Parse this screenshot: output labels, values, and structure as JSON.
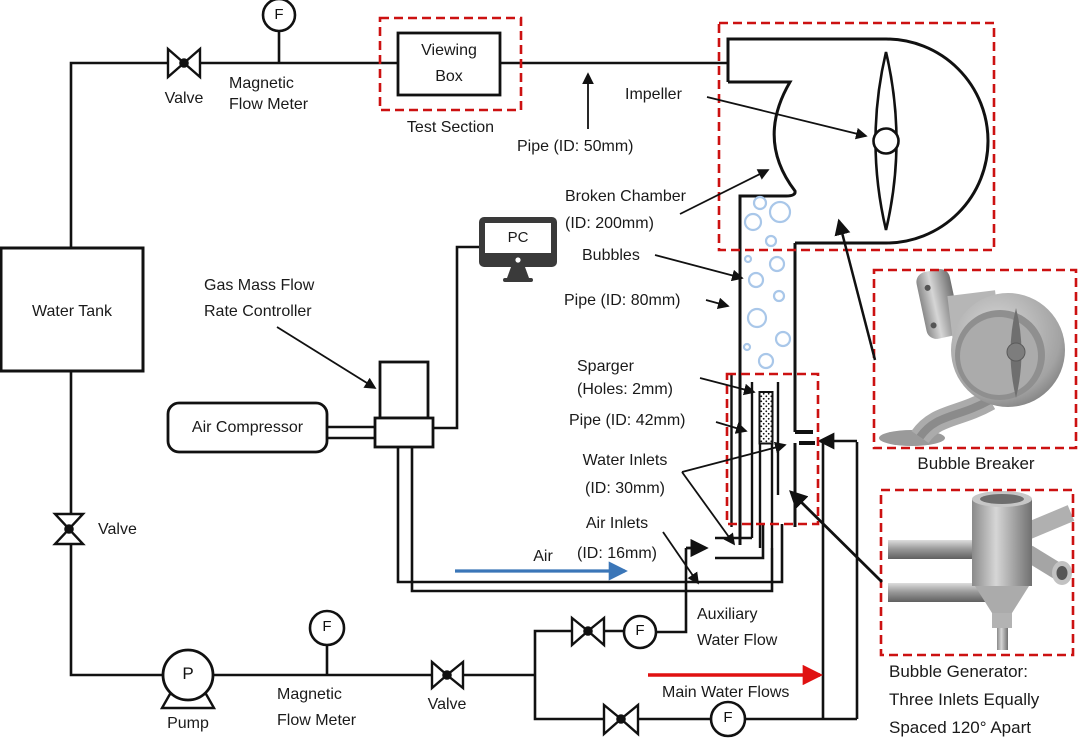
{
  "colors": {
    "line": "#111111",
    "dashed_box": "#cc1111",
    "bubble": "#a9c7e9",
    "air_arrow": "#3b76b8",
    "water_arrow": "#e01111",
    "metal_light": "#d2d2d2",
    "metal_mid": "#a8a8a8",
    "metal_dark": "#6e6e6e"
  },
  "symbols": {
    "flow_meter": "F",
    "pump": "P"
  },
  "labels": {
    "valve_top": "Valve",
    "magnetic_flow_meter_top": "Magnetic\nFlow Meter",
    "viewing_box": "Viewing\nBox",
    "test_section": "Test Section",
    "pipe_50": "Pipe (ID: 50mm)",
    "impeller": "Impeller",
    "broken_chamber": "Broken Chamber\n(ID: 200mm)",
    "bubbles": "Bubbles",
    "pipe_80": "Pipe (ID: 80mm)",
    "sparger": "Sparger\n(Holes: 2mm)",
    "pipe_42": "Pipe (ID: 42mm)",
    "water_inlets": "Water Inlets\n(ID: 30mm)",
    "air_inlets": "Air Inlets\n(ID: 16mm)",
    "air": "Air",
    "auxiliary_water_flow": "Auxiliary\nWater Flow",
    "main_water_flows": "Main Water Flows",
    "water_tank": "Water Tank",
    "gas_controller": "Gas Mass Flow\nRate Controller",
    "air_compressor": "Air Compressor",
    "pc": "PC",
    "valve_left": "Valve",
    "pump": "Pump",
    "magnetic_flow_meter_bottom": "Magnetic\nFlow Meter",
    "valve_bottom": "Valve",
    "bubble_breaker_caption": "Bubble Breaker",
    "bubble_generator_caption": "Bubble Generator:\nThree Inlets Equally\nSpaced 120° Apart"
  }
}
